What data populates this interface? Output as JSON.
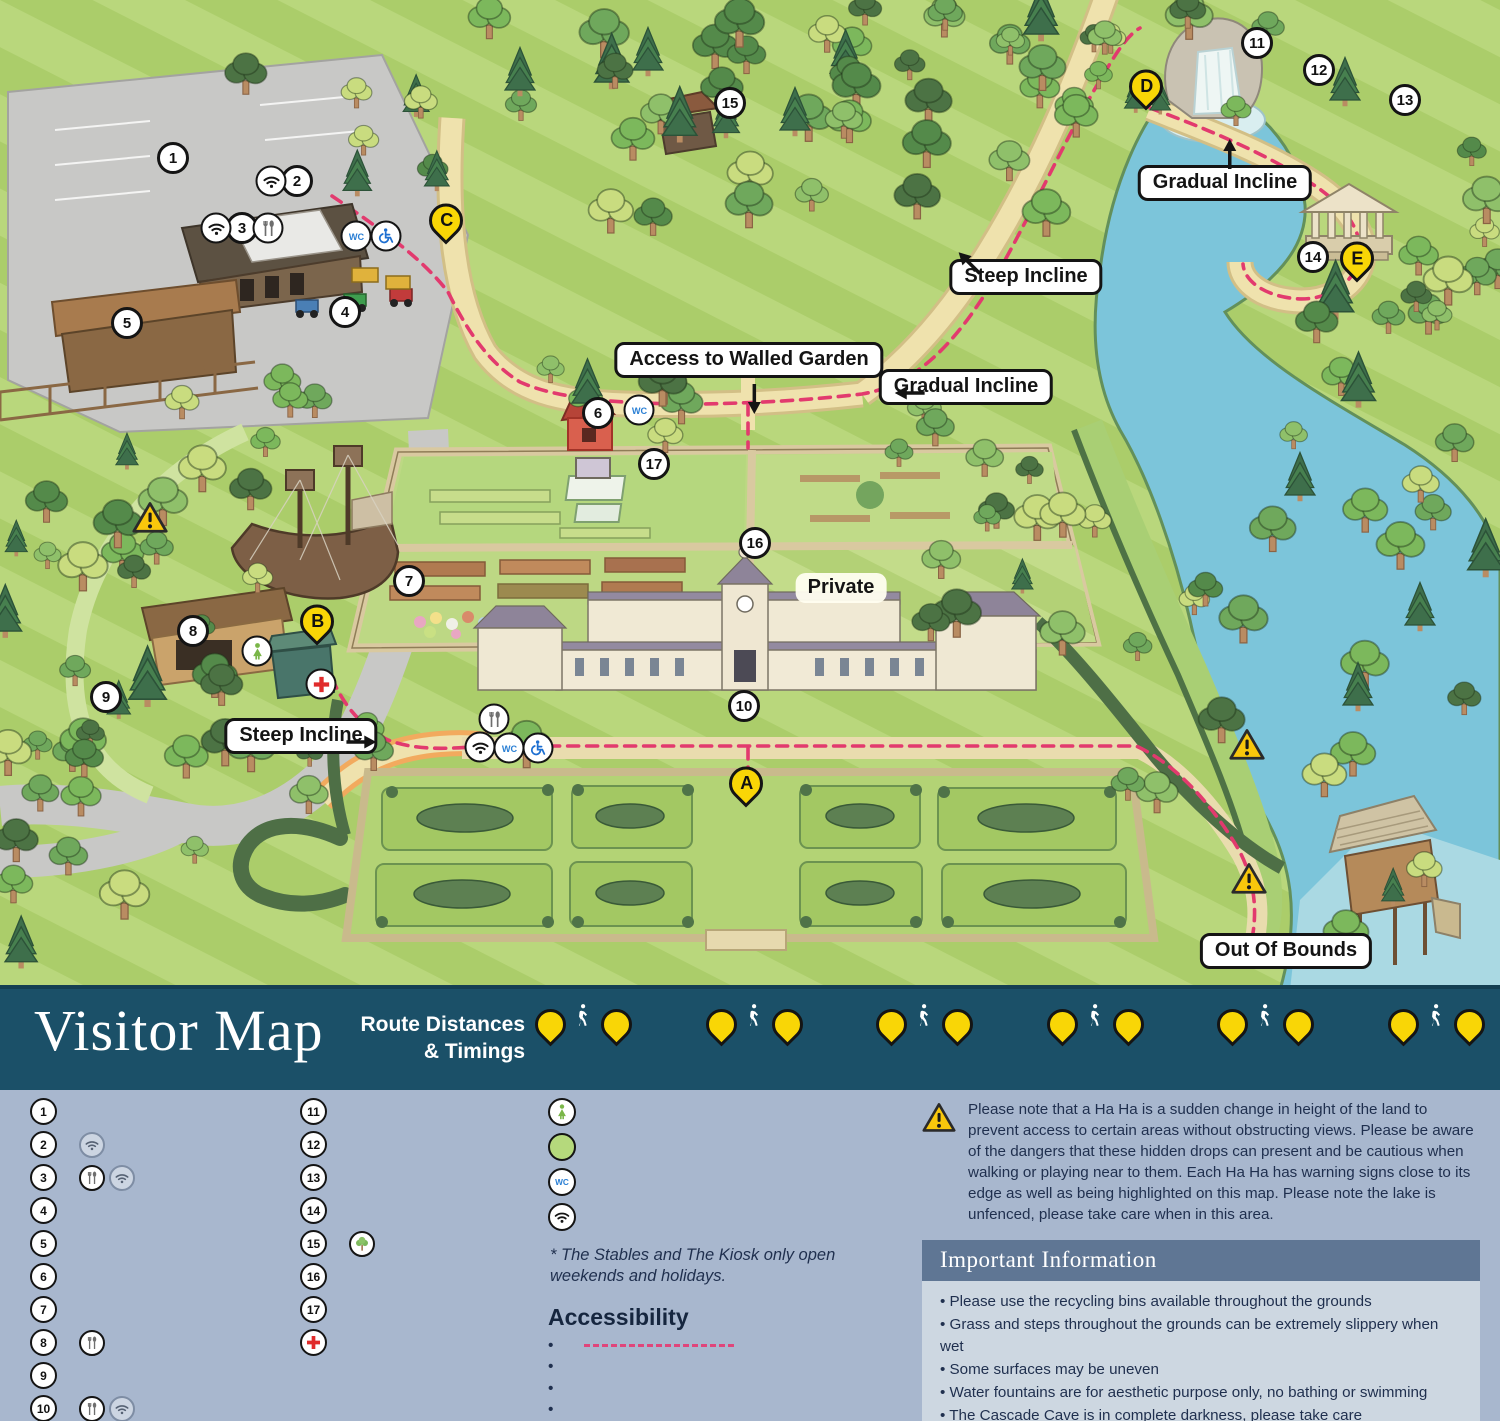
{
  "header": {
    "title": "Visitor Map",
    "route_heading_line1": "Route Distances",
    "route_heading_line2": "& Timings",
    "chevrons": "»»»»»»»",
    "routes": [
      {
        "from": "A",
        "to": "B",
        "distance": "200m",
        "time": "5 mins"
      },
      {
        "from": "A",
        "to": "C",
        "distance": "400m",
        "time": "7 mins"
      },
      {
        "from": "C",
        "to": "B",
        "distance": "200m",
        "time": "5 mins"
      },
      {
        "from": "C",
        "to": "D",
        "distance": "820m",
        "time": "15 mins"
      },
      {
        "from": "C",
        "to": "E",
        "distance": "1080m",
        "time": "20 mins"
      },
      {
        "from": "E",
        "to": "A",
        "distance": "950m",
        "time": "20 mins"
      }
    ]
  },
  "legend": {
    "column1": [
      {
        "num": "1",
        "label": "Visitor Car Park",
        "icons": []
      },
      {
        "num": "2",
        "label": "Admissions",
        "icons": [
          "wifi"
        ]
      },
      {
        "num": "3",
        "label": "Treehouse Café",
        "icons": [
          "food",
          "wifi"
        ]
      },
      {
        "num": "4",
        "label": "Mini Diggers",
        "icons": []
      },
      {
        "num": "5",
        "label": "The Den & Activity Barn",
        "icons": []
      },
      {
        "num": "6",
        "label": "Gardeners’ Bothy",
        "sub": "(Available to hire)",
        "icons": []
      },
      {
        "num": "7",
        "label": "Adventure Playground",
        "icons": []
      },
      {
        "num": "8",
        "label": "The Kiosk*",
        "icons": [
          "food"
        ]
      },
      {
        "num": "9",
        "label": "Under 7s Play Area",
        "icons": []
      },
      {
        "num": "10",
        "label": "Bowood House, Terrace Shop and The Stables*",
        "icons": [
          "food",
          "wifi"
        ]
      }
    ],
    "column2": [
      {
        "num": "11",
        "label": "Cascade",
        "icons": []
      },
      {
        "num": "12",
        "label": "Cascade Cave",
        "icons": []
      },
      {
        "num": "13",
        "label": "Hermit’s Cave",
        "icons": []
      },
      {
        "num": "14",
        "label": "Doric Temple",
        "icons": []
      },
      {
        "num": "15",
        "label": "Arboretum / Pinetum",
        "sub": "Follow the tree trail to discover 24 magnificent trees.",
        "icons": [
          "tree"
        ]
      },
      {
        "num": "16",
        "label": "Walled Garden",
        "sub": "Open daily between 12:00 – 16:30, pre-booked morning tours",
        "icons": []
      },
      {
        "num": "17",
        "label": "Garden Studio",
        "icons": []
      },
      {
        "icon": "firstaid",
        "label": "First Aid",
        "icons": []
      }
    ],
    "symbols": [
      {
        "icon": "lostchild",
        "label": "Lost Child Point"
      },
      {
        "icon": "private",
        "label": "Private/Out of bounds"
      },
      {
        "icon": "wc",
        "label": "Toilets",
        "sub": "Disabled access and baby changing facilities are available within the Treehouse Café and Bowood House"
      },
      {
        "icon": "wifi",
        "label": "Free Wi-Fi Points"
      }
    ],
    "footnote": "* The Stables and The Kiosk only open weekends and holidays."
  },
  "accessibility": {
    "title": "Accessibility",
    "items": [
      {
        "text": "Wheelchair route",
        "dash": true
      },
      {
        "text": "Wheelchairs are available on request at Admissions"
      },
      {
        "text": "Assistance dogs are welcome"
      },
      {
        "text": "Wheelchair users can access the Treehouse Café, The Stables and the ground floor of Bowood House"
      }
    ]
  },
  "warning_note": "Please note that a Ha Ha is a sudden change in height of the land to prevent access to certain areas without obstructing views. Please be aware of the dangers that these hidden drops can present and be cautious when walking or playing near to them. Each Ha Ha has warning signs close to its edge as well as being highlighted on this map. Please note the lake is unfenced, please take care when in this area.",
  "important_info": {
    "title": "Important Information",
    "items": [
      "Please use the recycling bins available throughout the grounds",
      "Grass and steps throughout the grounds can be extremely slippery when wet",
      "Some surfaces may be uneven",
      "Water fountains are for aesthetic purpose only, no bathing or swimming",
      "The Cascade Cave is in complete darkness, please take care",
      "Bowood Lake is strictly off limits to the general public",
      "Smoking or vaping are not permitted on site"
    ]
  },
  "map": {
    "numbered_markers": [
      {
        "num": "1",
        "x": 173,
        "y": 158
      },
      {
        "num": "2",
        "x": 297,
        "y": 181
      },
      {
        "num": "3",
        "x": 242,
        "y": 228
      },
      {
        "num": "4",
        "x": 345,
        "y": 312
      },
      {
        "num": "5",
        "x": 127,
        "y": 323
      },
      {
        "num": "6",
        "x": 598,
        "y": 413
      },
      {
        "num": "7",
        "x": 409,
        "y": 581
      },
      {
        "num": "8",
        "x": 193,
        "y": 631
      },
      {
        "num": "9",
        "x": 106,
        "y": 697
      },
      {
        "num": "10",
        "x": 744,
        "y": 706
      },
      {
        "num": "11",
        "x": 1257,
        "y": 43
      },
      {
        "num": "12",
        "x": 1319,
        "y": 70
      },
      {
        "num": "13",
        "x": 1405,
        "y": 100
      },
      {
        "num": "14",
        "x": 1313,
        "y": 257
      },
      {
        "num": "15",
        "x": 730,
        "y": 103
      },
      {
        "num": "16",
        "x": 755,
        "y": 543
      },
      {
        "num": "17",
        "x": 654,
        "y": 464
      }
    ],
    "letter_pins": [
      {
        "letter": "A",
        "x": 746,
        "y": 791
      },
      {
        "letter": "B",
        "x": 317,
        "y": 629
      },
      {
        "letter": "C",
        "x": 446,
        "y": 228
      },
      {
        "letter": "D",
        "x": 1146,
        "y": 94
      },
      {
        "letter": "E",
        "x": 1357,
        "y": 266
      }
    ],
    "icon_markers": [
      {
        "icon": "wifi",
        "x": 271,
        "y": 181
      },
      {
        "icon": "wifi",
        "x": 216,
        "y": 228
      },
      {
        "icon": "food",
        "x": 268,
        "y": 228
      },
      {
        "icon": "wc",
        "x": 356,
        "y": 236
      },
      {
        "icon": "access",
        "x": 386,
        "y": 236
      },
      {
        "icon": "wc",
        "x": 639,
        "y": 410
      },
      {
        "icon": "food",
        "x": 494,
        "y": 719
      },
      {
        "icon": "wifi",
        "x": 480,
        "y": 747
      },
      {
        "icon": "wc",
        "x": 509,
        "y": 748
      },
      {
        "icon": "access",
        "x": 538,
        "y": 748
      },
      {
        "icon": "lostchild",
        "x": 257,
        "y": 651
      },
      {
        "icon": "firstaid",
        "x": 321,
        "y": 684
      }
    ],
    "warning_markers": [
      {
        "x": 150,
        "y": 520
      },
      {
        "x": 1247,
        "y": 747
      },
      {
        "x": 1249,
        "y": 881
      }
    ],
    "labels": [
      {
        "text": "Gradual Incline",
        "x": 1225,
        "y": 183,
        "arrow": "up"
      },
      {
        "text": "Steep Incline",
        "x": 1026,
        "y": 277,
        "arrow": "upleft"
      },
      {
        "text": "Access to Walled Garden",
        "x": 749,
        "y": 360,
        "arrow": "down"
      },
      {
        "text": "Gradual Incline",
        "x": 966,
        "y": 387,
        "arrow": "left"
      },
      {
        "text": "Steep Incline",
        "x": 301,
        "y": 736,
        "arrow": "right"
      },
      {
        "text": "Private",
        "x": 841,
        "y": 588,
        "plain": true
      },
      {
        "text": "Out Of Bounds",
        "x": 1286,
        "y": 951
      }
    ]
  }
}
